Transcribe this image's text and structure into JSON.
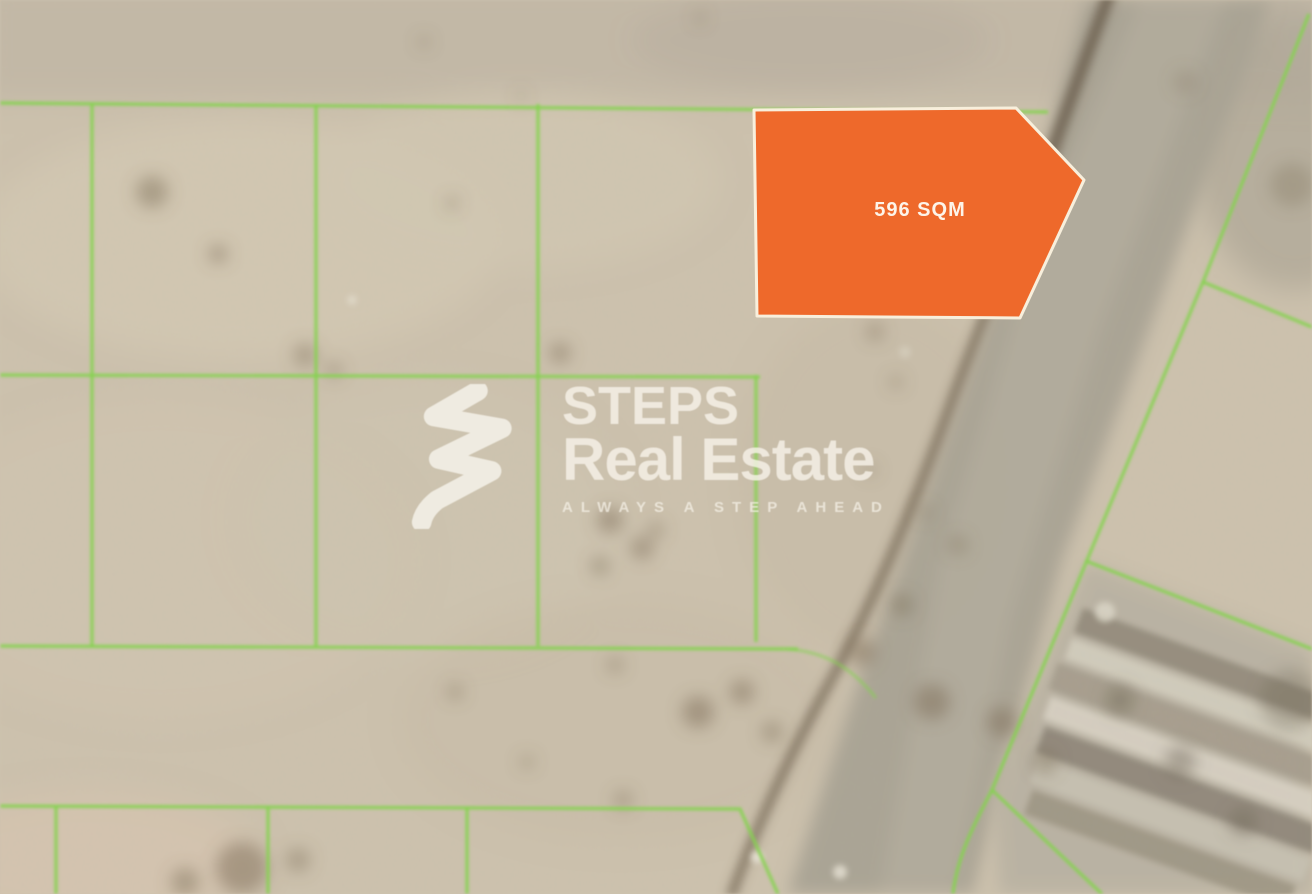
{
  "map": {
    "type": "satellite-aerial-view",
    "land_color": "#cdc2ae",
    "road_color": "#a9a395"
  },
  "parcel": {
    "label": "596 SQM",
    "fill_color": "#ee692b",
    "border_color": "#f8efdc"
  },
  "boundaries": {
    "line_color": "#84d44e"
  },
  "watermark": {
    "logo_icon": "steps-swoosh-icon",
    "brand_line1": "STEPS",
    "brand_line2": "Real Estate",
    "tagline": "ALWAYS A STEP AHEAD",
    "text_color": "#f7f3ea"
  }
}
